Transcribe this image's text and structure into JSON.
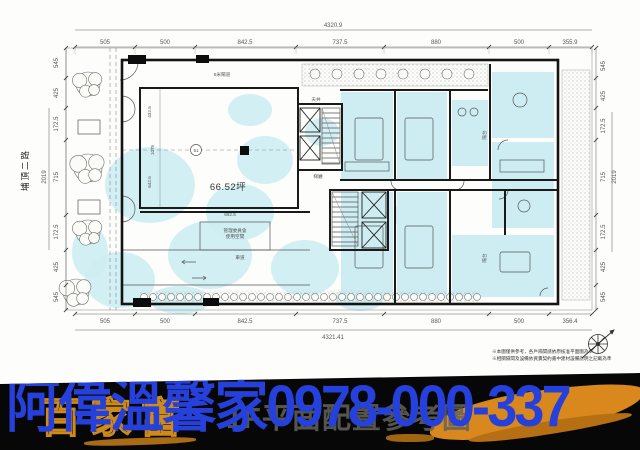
{
  "plan": {
    "road_label": "埔頂二路",
    "area_label": "66.52坪",
    "unit_circle": "51",
    "gate_label": "8米閘道",
    "court_label": "天井",
    "lobby_label": "梯廳",
    "admin_label_1": "管理委員會",
    "admin_label_2": "使用空間",
    "driveway_label": "車道",
    "balcony_label": "陽台",
    "inner_dims": {
      "d1": "432.5",
      "d2": "1075",
      "d3": "642.5",
      "d4": "692.5"
    },
    "dims_top_total": "4320.9",
    "dims_top": [
      "505",
      "500",
      "842.5",
      "737.5",
      "880",
      "500",
      "355.9"
    ],
    "dims_bottom": [
      "505",
      "500",
      "842.5",
      "737.5",
      "880",
      "500",
      "356.4"
    ],
    "dims_bottom_total": "4321.41",
    "dims_left": [
      "545",
      "425",
      "172.5",
      "715",
      "172.5",
      "425",
      "545"
    ],
    "dims_left_total": "2019",
    "dims_right": [
      "545",
      "425",
      "172.5",
      "715",
      "172.5",
      "425",
      "545"
    ],
    "dims_right_total": "2019",
    "notes": [
      "※本圖僅供參考，各戶隔間請依原核准平面圖為準",
      "※相關隔間及設備依買賣契約書中建材設備說明之記載為準"
    ],
    "watermark_color": "#cdedf2"
  },
  "banner": {
    "agent_name": "阿偉溫馨家",
    "phone": "0978-000-337",
    "bg_text_left": "百家富",
    "bg_caption": "1F平面配置參考圖",
    "text_color": "#2640db",
    "accent_color": "#d8881c",
    "background_color": "#070707"
  }
}
